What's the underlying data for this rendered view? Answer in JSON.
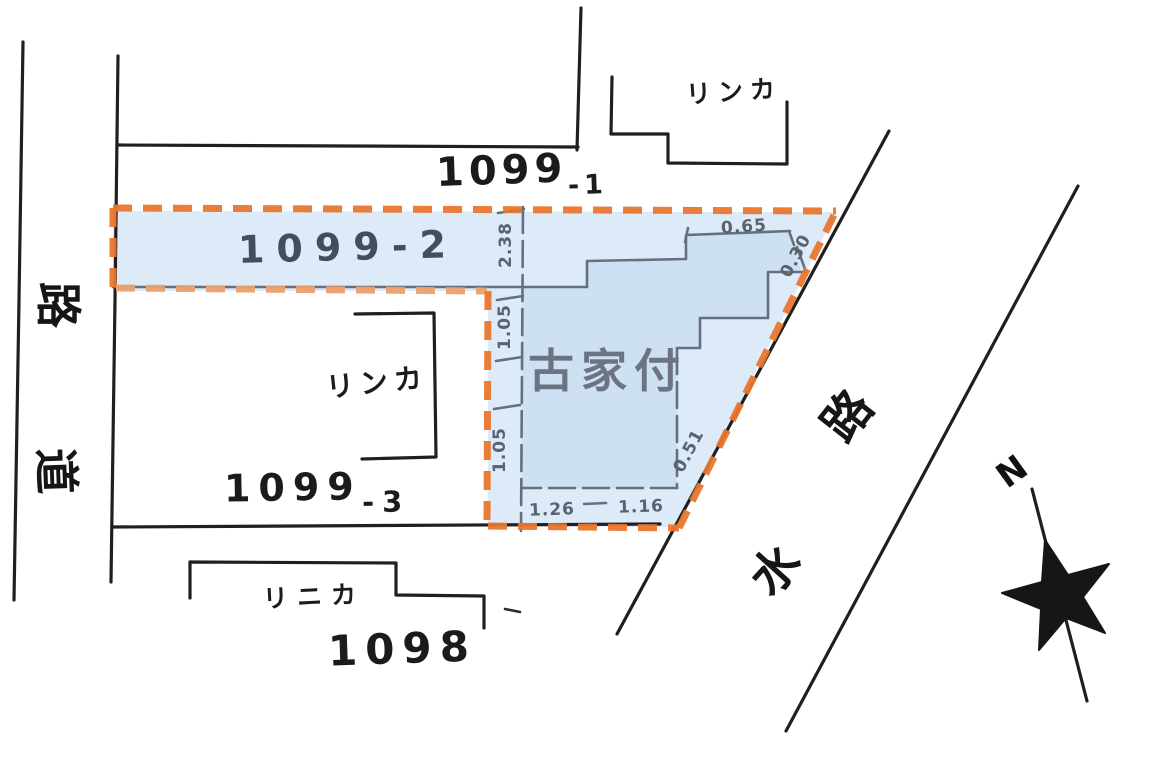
{
  "parcels": {
    "p1099_1": {
      "main": "1099",
      "sub": "-1"
    },
    "p1099_2": {
      "label": "1099-2"
    },
    "p1099_3": {
      "main": "1099",
      "sub": "-3"
    },
    "p1098": {
      "label": "1098"
    }
  },
  "annotations": {
    "old_house": "古家付",
    "building_top": "リンカ",
    "building_mid": "リンカ",
    "building_bottom": "リニカ"
  },
  "roads": {
    "left_road": {
      "name": "道路",
      "char1": "道",
      "char2": "路"
    },
    "waterway": {
      "name": "水路",
      "char1": "水",
      "char2": "路"
    }
  },
  "measurements": [
    {
      "value": "2.38"
    },
    {
      "value": "1.05"
    },
    {
      "value": "1.05"
    },
    {
      "value": "1.26"
    },
    {
      "value": "1.16"
    },
    {
      "value": "0.65"
    },
    {
      "value": "0.30"
    },
    {
      "value": "0.51"
    }
  ],
  "compass": {
    "north_label": "N"
  },
  "colors": {
    "highlight_fill": "#dbe9f7",
    "house_fill": "#c9def1",
    "boundary_orange": "#e8762e",
    "line_black": "#1f1f1f",
    "line_gray": "#65707e",
    "dim_text_gray": "#59636f"
  }
}
